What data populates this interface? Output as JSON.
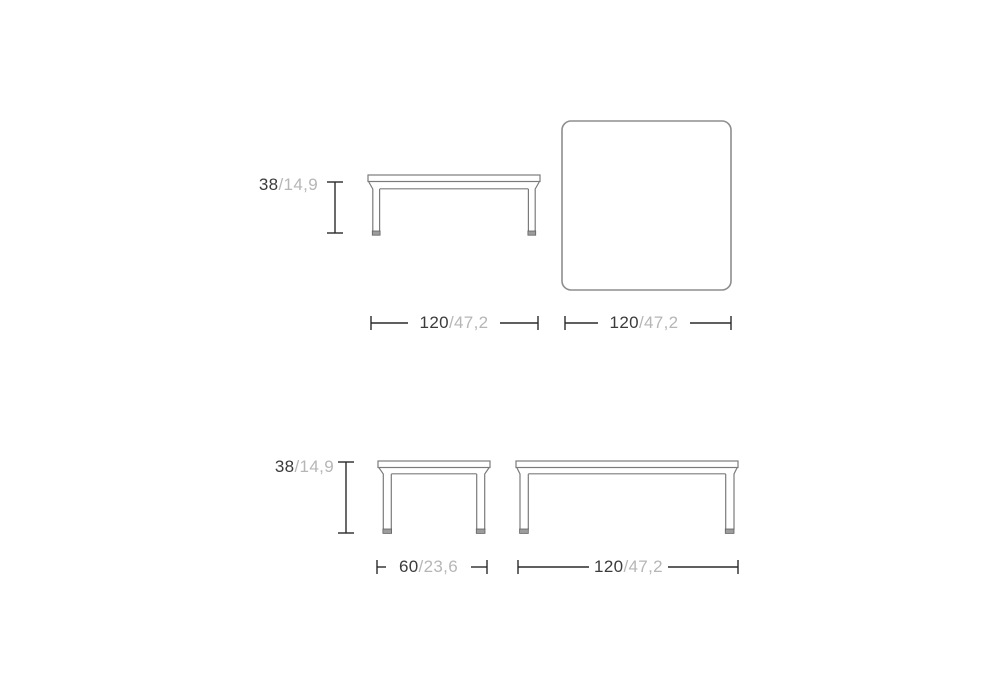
{
  "page": {
    "background": "#ffffff"
  },
  "palette": {
    "text_primary": "#3b3b3d",
    "text_secondary": "#b6b6b8",
    "dimension_line": "#2a2a2a",
    "drawing_outline": "#7b7b7b",
    "top_view_outline": "#8e8e8e",
    "foot_fill": "#9c9c9c"
  },
  "diagram": {
    "top_row": {
      "height_dimension": {
        "value": "38",
        "alt": "/14,9"
      },
      "front_view_width_dimension": {
        "value": "120",
        "alt": "/47,2"
      },
      "top_view_width_dimension": {
        "value": "120",
        "alt": "/47,2"
      }
    },
    "bottom_row": {
      "height_dimension": {
        "value": "38",
        "alt": "/14,9"
      },
      "small_table_width_dimension": {
        "value": "60",
        "alt": "/23,6"
      },
      "large_table_width_dimension": {
        "value": "120",
        "alt": "/47,2"
      }
    }
  }
}
